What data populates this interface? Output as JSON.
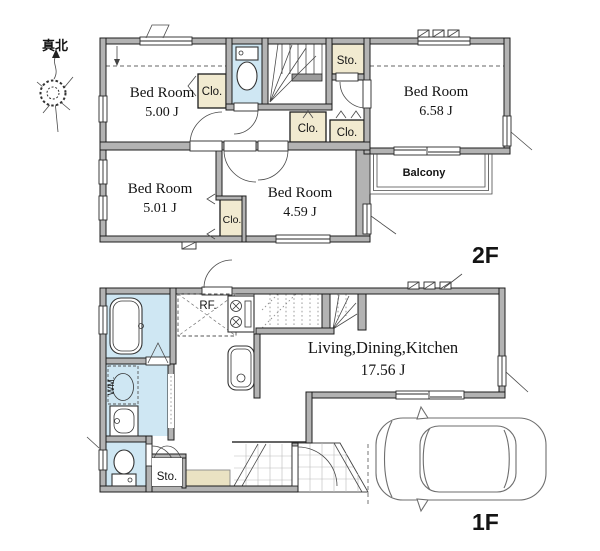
{
  "compass": {
    "label": "真北"
  },
  "colors": {
    "wall": "#b3b3b3",
    "closet_fill": "#f1ead0",
    "wet_area_fill": "#cfe7f3",
    "genkan_fill": "#eae2c3",
    "line": "#1c1c1c"
  },
  "floor2": {
    "label": "2F",
    "bedroom_nw": {
      "name": "Bed Room",
      "area": "5.00 J"
    },
    "bedroom_ne": {
      "name": "Bed Room",
      "area": "6.58 J"
    },
    "bedroom_sw": {
      "name": "Bed Room",
      "area": "5.01 J"
    },
    "bedroom_se": {
      "name": "Bed Room",
      "area": "4.59 J"
    },
    "closet_nw": "Clo.",
    "closet_hall_left": "Clo.",
    "closet_hall_right": "Clo.",
    "closet_sw": "Clo.",
    "storage": "Sto.",
    "balcony": "Balcony"
  },
  "floor1": {
    "label": "1F",
    "ldk": {
      "name": "Living,Dining,Kitchen",
      "area": "17.56 J"
    },
    "refrigerator": "RF.",
    "washing_machine": "WM.",
    "storage": "Sto."
  }
}
